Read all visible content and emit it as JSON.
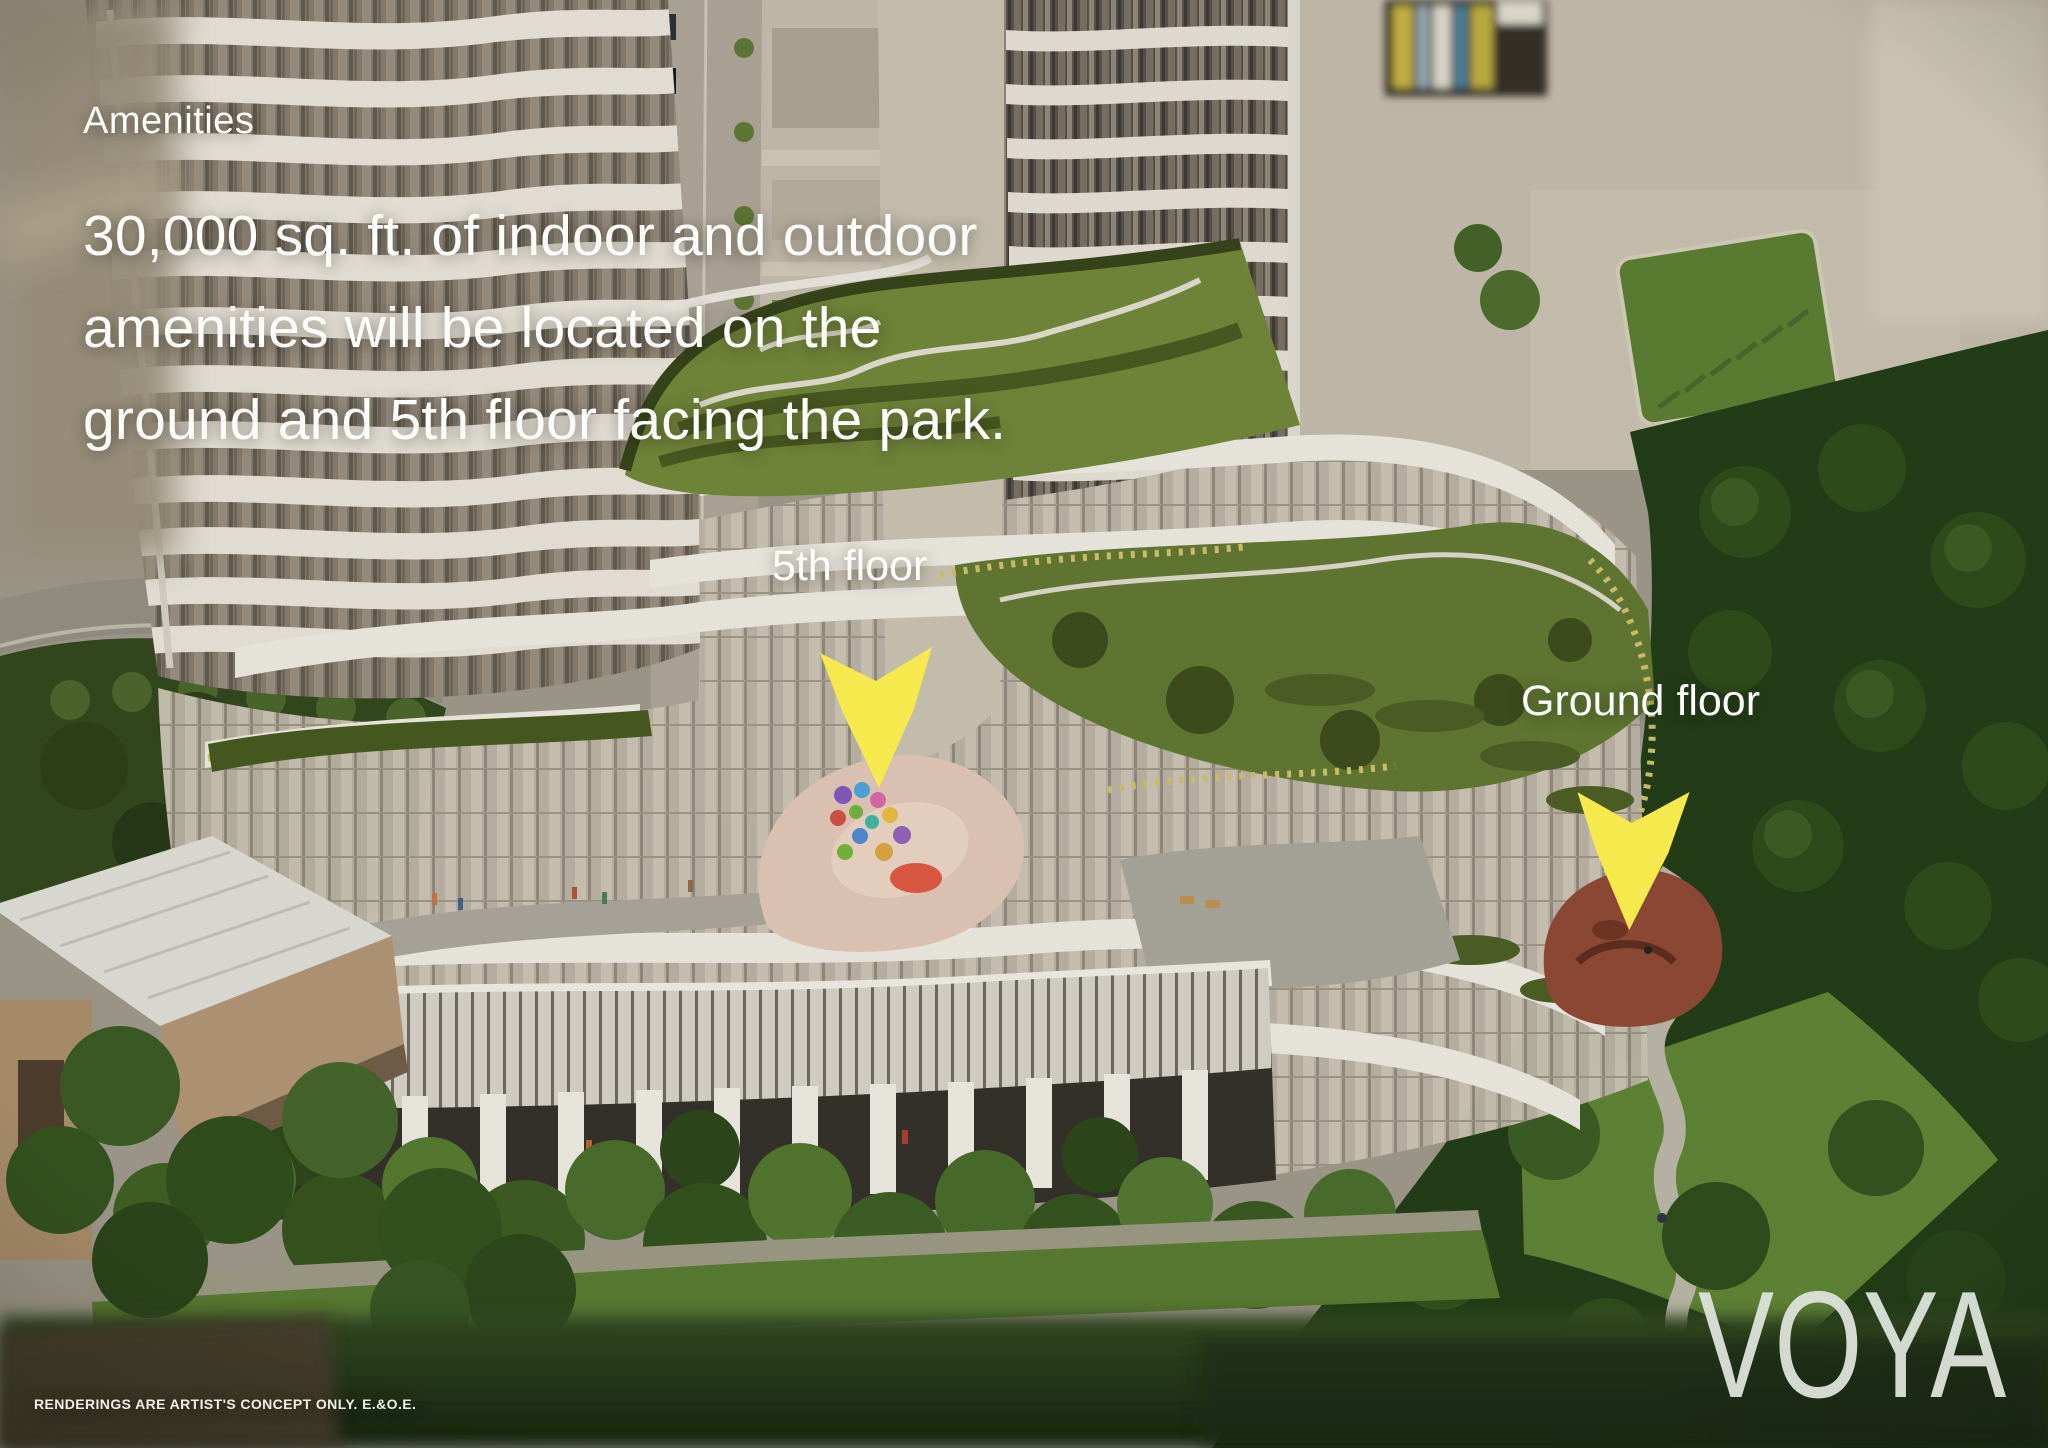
{
  "annotations": {
    "heading": "Amenities",
    "body_line_1": "30,000 sq. ft. of indoor and outdoor",
    "body_line_2": "amenities will be located on the",
    "body_line_3": "ground and 5th floor facing the park.",
    "fifth_floor_label": "5th floor",
    "ground_floor_label": "Ground floor"
  },
  "branding": {
    "logo_text": "VOYA"
  },
  "footer": {
    "disclaimer": "RENDERINGS ARE ARTIST'S CONCEPT ONLY. E.&O.E."
  },
  "style": {
    "text_color": "#ffffff",
    "arrow_color": "#f6e94d",
    "logo_color": "#dde3da"
  }
}
